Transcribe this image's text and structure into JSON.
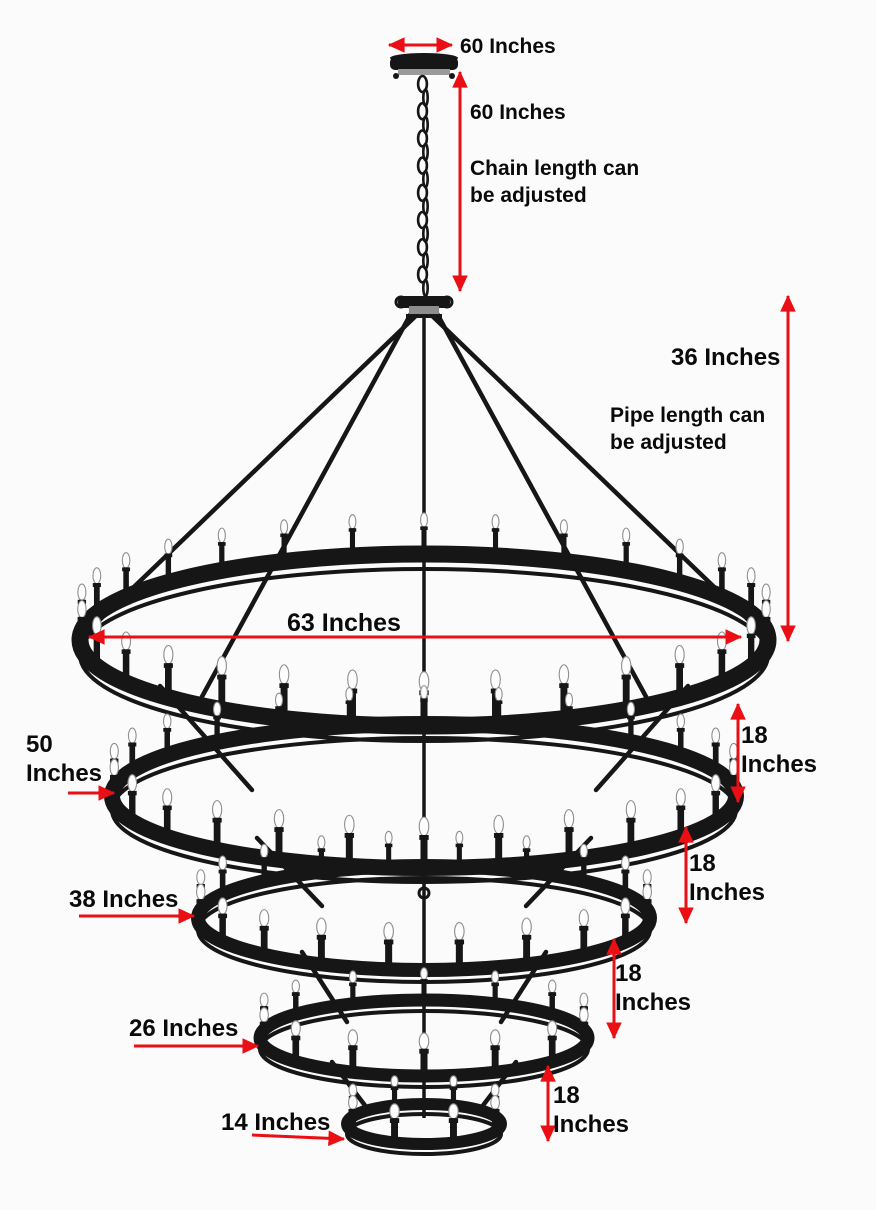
{
  "title": "Five-tier wrought iron chandelier dimension diagram",
  "colors": {
    "arrow_red": "#e90f14",
    "metal_black": "#161616",
    "bulb_white": "#fdfdfd",
    "bulb_outline": "#8f8f8f",
    "text_black": "#0a0a0a",
    "background": "#fbfbfb"
  },
  "annotations": {
    "canopy_width": "60 Inches",
    "chain_length": "60 Inches",
    "chain_note_1": "Chain length can",
    "chain_note_2": "be adjusted",
    "pipe_length": "36 Inches",
    "pipe_note_1": "Pipe length can",
    "pipe_note_2": "be adjusted",
    "tier1_diameter": "63 Inches",
    "tier2_diameter_1": "50",
    "tier2_diameter_2": "Inches",
    "tier3_diameter": "38 Inches",
    "tier4_diameter": "26 Inches",
    "tier5_diameter": "14 Inches",
    "gap_value": "18",
    "gap_unit": "Inches"
  },
  "chandelier": {
    "tier_count": 5,
    "tier_spacing_inches": 18,
    "chain_length_inches": 60,
    "pipe_length_inches": 36,
    "canopy_label_inches": 60,
    "tiers": [
      {
        "name": "tier-1",
        "diameter_inches": 63,
        "candles": 30
      },
      {
        "name": "tier-2",
        "diameter_inches": 50,
        "candles": 26
      },
      {
        "name": "tier-3",
        "diameter_inches": 38,
        "candles": 20
      },
      {
        "name": "tier-4",
        "diameter_inches": 26,
        "candles": 14
      },
      {
        "name": "tier-5",
        "diameter_inches": 14,
        "candles": 8
      }
    ]
  }
}
